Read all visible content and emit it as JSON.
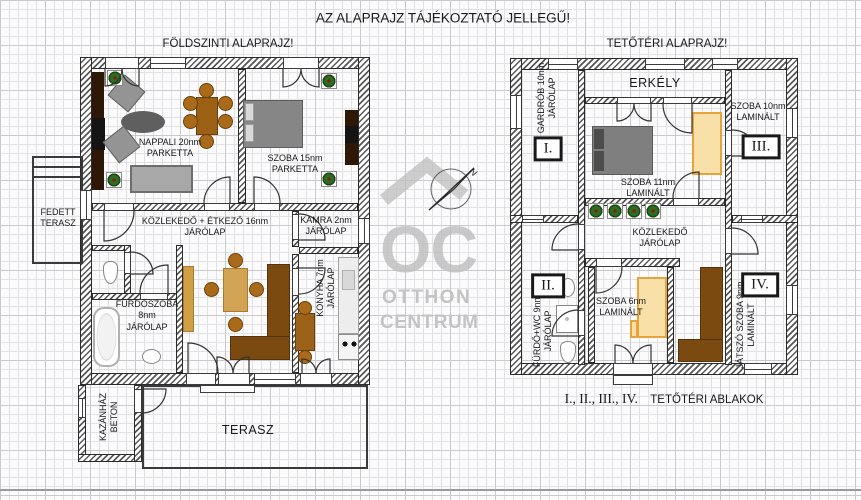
{
  "page_title": "AZ ALAPRAJZ TÁJÉKOZTATÓ JELLEGŰ!",
  "watermark": {
    "logo": "OC",
    "brand_line1": "OTTHON",
    "brand_line2": "CENTRUM",
    "north_letter": "N"
  },
  "ground_floor": {
    "title": "FÖLDSZINTI ALAPRAJZ!",
    "rooms": {
      "nappali": "NAPPALI 20nm\nPARKETTA",
      "szoba15": "SZOBA 15nm\nPARKETTA",
      "kozlekedo": "KÖZLEKEDŐ + ÉTKEZŐ 16nm\nJÁRÓLAP",
      "kamra": "KAMRA 2nm\nJÁRÓLAP",
      "konyha": "KONYHA 7nm\nJÁRÓLAP",
      "furdoszoba": "FÜRDŐSZOBA\n8nm\nJÁRÓLAP",
      "fedett_terasz": "FEDETT\nTERASZ",
      "kazanhaz": "KAZÁNHÁZ\nBETON",
      "terasz": "TERASZ"
    }
  },
  "attic": {
    "title": "TETŐTÉRI ALAPRAJZ!",
    "rooms": {
      "erkely": "ERKÉLY",
      "gardrob": "GARDRÓB 10nm\nJÁRÓLAP",
      "szoba11": "SZOBA 11nm\nLAMINÁLT",
      "szoba10": "SZOBA 10nm\nLAMINÁLT",
      "kozlekedo": "KÖZLEKEDŐ\nJÁRÓLAP",
      "furdo_wc": "FÜRDŐ+WC 9nm\nJÁRÓLAP",
      "szoba6": "SZOBA 6nm\nLAMINÁLT",
      "jatszo_szoba": "JÁTSZÓ SZOBA 9nm\nLAMINÁLT"
    },
    "window_markers": {
      "i": "I.",
      "ii": "II.",
      "iii": "III.",
      "iv": "IV."
    },
    "caption": {
      "numerals": "I., II., III., IV.",
      "text": "TETŐTÉRI ABLAKOK"
    }
  },
  "colors": {
    "wall_hatch": "#585858",
    "furniture_brown": "#7b4a10",
    "furniture_light_brown": "#d2a352",
    "furniture_tan_fill": "#f8e0a8",
    "furniture_tan_border": "#e8a33d",
    "furniture_gray": "#828282",
    "watermark_gray": "#bcbcbc"
  }
}
